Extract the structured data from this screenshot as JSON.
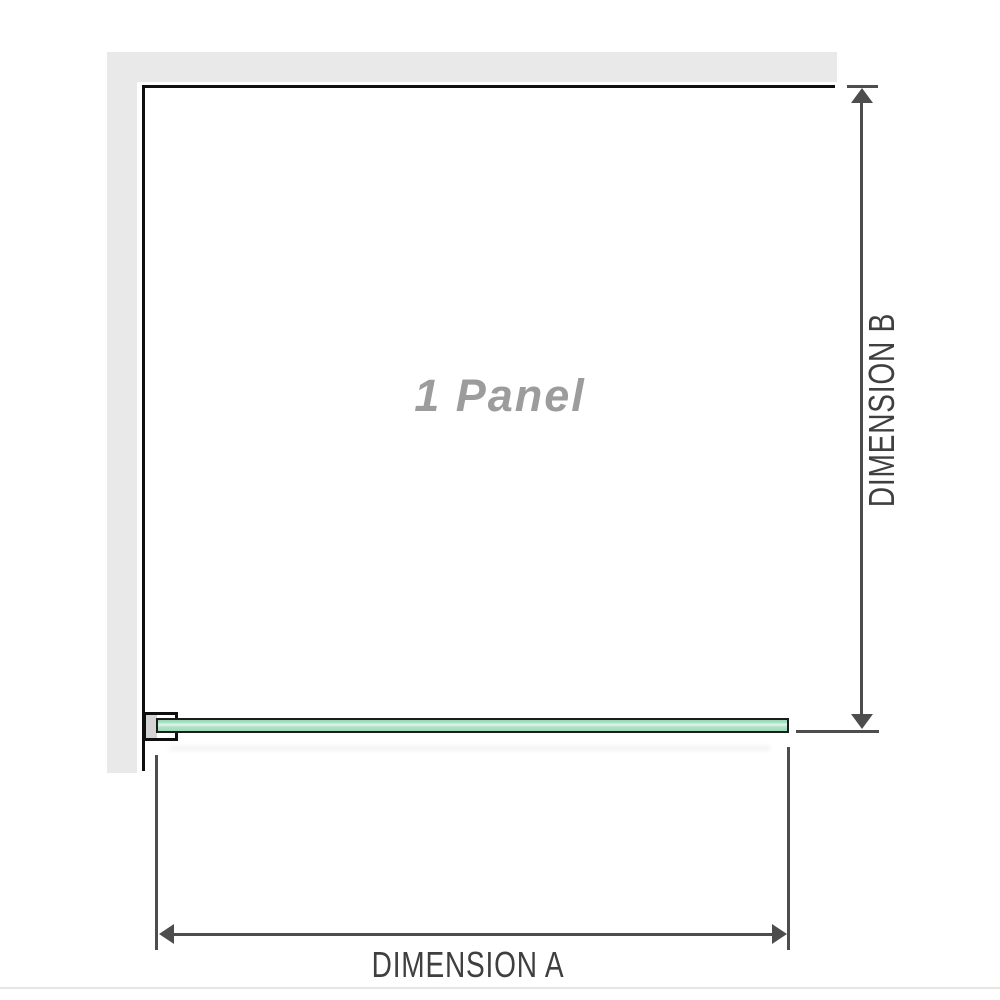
{
  "diagram": {
    "panel_label": "1 Panel",
    "dimension_a": {
      "label": "DIMENSION A",
      "measures": "panel width"
    },
    "dimension_b": {
      "label": "DIMENSION B",
      "measures": "panel depth"
    }
  },
  "colors": {
    "wall_gray": "#e9e9e9",
    "panel_outline_black": "#0f0f0f",
    "glass_green": "#a9e0c4",
    "glass_highlight": "#e3f5ec",
    "glass_edge": "#1c1c1c",
    "bracket_pad_gray": "#d4d4d4",
    "dimension_line_gray": "#4d4d4d",
    "dimension_text_gray": "#3f3f3f",
    "panel_label_gray": "#9c9c9c",
    "page_divider_gray": "#e5e5e1"
  }
}
